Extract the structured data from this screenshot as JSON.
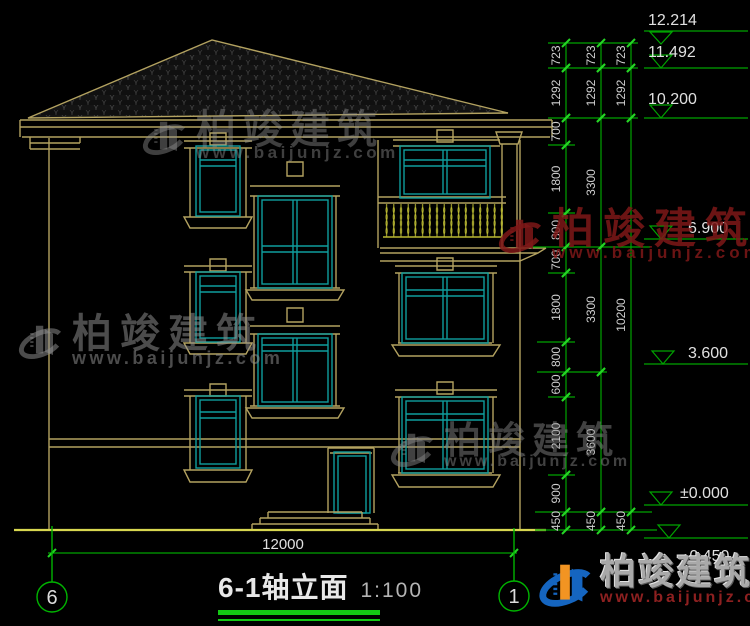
{
  "title": {
    "text": "6-1轴立面",
    "scale": "1:100"
  },
  "axis_markers": {
    "left": "6",
    "right": "1"
  },
  "watermark": {
    "brand": "柏竣建筑",
    "url": "www.baijunjz.com"
  },
  "colors": {
    "background": "#000000",
    "structure_tan": "#b3a260",
    "window_teal": "#0f9d9d",
    "baluster_yellow": "#b9b832",
    "ground_yellow": "#d8d750",
    "dim_green": "#00a400",
    "tick_green": "#25d425",
    "dim_text": "#cfcfcf",
    "title_underline": "#14c814"
  },
  "bottom_dimension": {
    "label": "12000",
    "y": 553,
    "x1": 48,
    "x2": 517,
    "ticks": [
      52,
      514
    ],
    "label_x": 283,
    "label_y": 549
  },
  "dimensions": {
    "chains": [
      {
        "x": 566,
        "segments": [
          [
            "723",
            43,
            68
          ],
          [
            "1292",
            68,
            118
          ],
          [
            "700",
            118,
            145
          ],
          [
            "1800",
            145,
            213
          ],
          [
            "800",
            213,
            247
          ],
          [
            "700",
            247,
            273
          ],
          [
            "1800",
            273,
            342
          ],
          [
            "800",
            342,
            372
          ],
          [
            "600",
            372,
            397
          ],
          [
            "2100",
            397,
            475
          ],
          [
            "900",
            475,
            512
          ],
          [
            "450",
            512,
            530
          ]
        ]
      },
      {
        "x": 601,
        "segments": [
          [
            "723",
            43,
            68
          ],
          [
            "1292",
            68,
            118
          ],
          [
            "3300",
            118,
            247
          ],
          [
            "3300",
            247,
            372
          ],
          [
            "3600",
            372,
            512
          ],
          [
            "450",
            512,
            530
          ]
        ]
      },
      {
        "x": 631,
        "segments": [
          [
            "723",
            43,
            68
          ],
          [
            "1292",
            68,
            118
          ],
          [
            "10200",
            118,
            512
          ],
          [
            "450",
            512,
            530
          ]
        ]
      }
    ],
    "extension_lines": [
      [
        43,
        548,
        638
      ],
      [
        68,
        548,
        638
      ],
      [
        118,
        548,
        638
      ],
      [
        145,
        548,
        575
      ],
      [
        213,
        548,
        575
      ],
      [
        247,
        532,
        650
      ],
      [
        273,
        548,
        575
      ],
      [
        342,
        537,
        575
      ],
      [
        372,
        537,
        607
      ],
      [
        397,
        548,
        575
      ],
      [
        475,
        548,
        575
      ],
      [
        512,
        535,
        652
      ],
      [
        530,
        535,
        657
      ]
    ],
    "elevation_markers": [
      {
        "label": "12.214",
        "y": 31,
        "tri": "below",
        "trix": 650,
        "tx": 648,
        "ty": 25
      },
      {
        "label": "11.492",
        "y": 68,
        "tri": "above",
        "trix": 650,
        "tx": 648,
        "ty": 57
      },
      {
        "label": "10.200",
        "y": 118,
        "tri": "above",
        "trix": 650,
        "tx": 648,
        "ty": 104
      },
      {
        "label": "6.900",
        "y": 239,
        "tri": "above",
        "trix": 650,
        "tx": 688,
        "ty": 233
      },
      {
        "label": "3.600",
        "y": 364,
        "tri": "above",
        "trix": 652,
        "tx": 688,
        "ty": 358
      },
      {
        "label": "±0.000",
        "y": 505,
        "tri": "above",
        "trix": 650,
        "tx": 680,
        "ty": 498
      },
      {
        "label": "-0.450",
        "y": 538,
        "tri": "above",
        "trix": 658,
        "tx": 684,
        "ty": 561
      }
    ]
  }
}
